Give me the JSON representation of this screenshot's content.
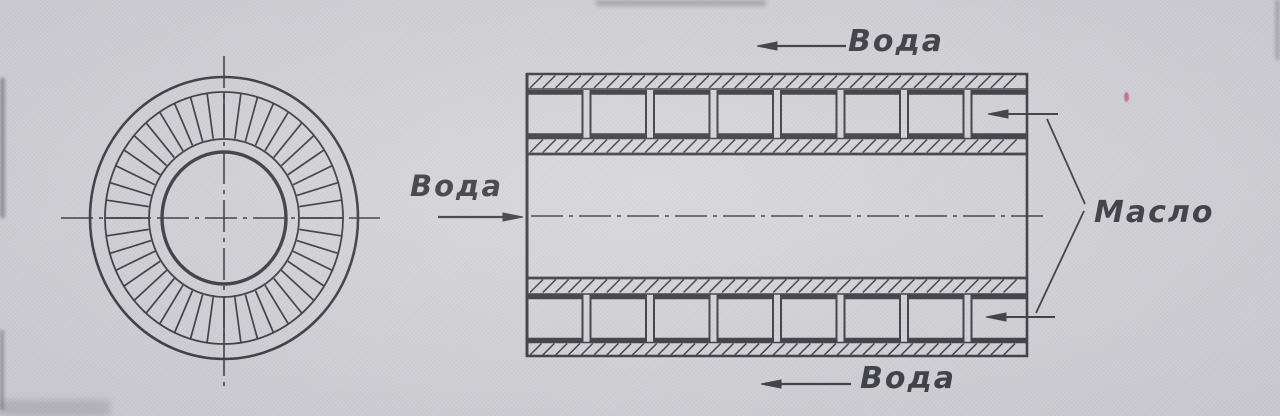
{
  "drawing": {
    "labels": {
      "water_top": "Вода",
      "water_left": "Вода",
      "water_bottom": "Вода",
      "oil": "Масло"
    },
    "colors": {
      "paper": "#d6d5da",
      "ink": "#3b3b42"
    }
  }
}
